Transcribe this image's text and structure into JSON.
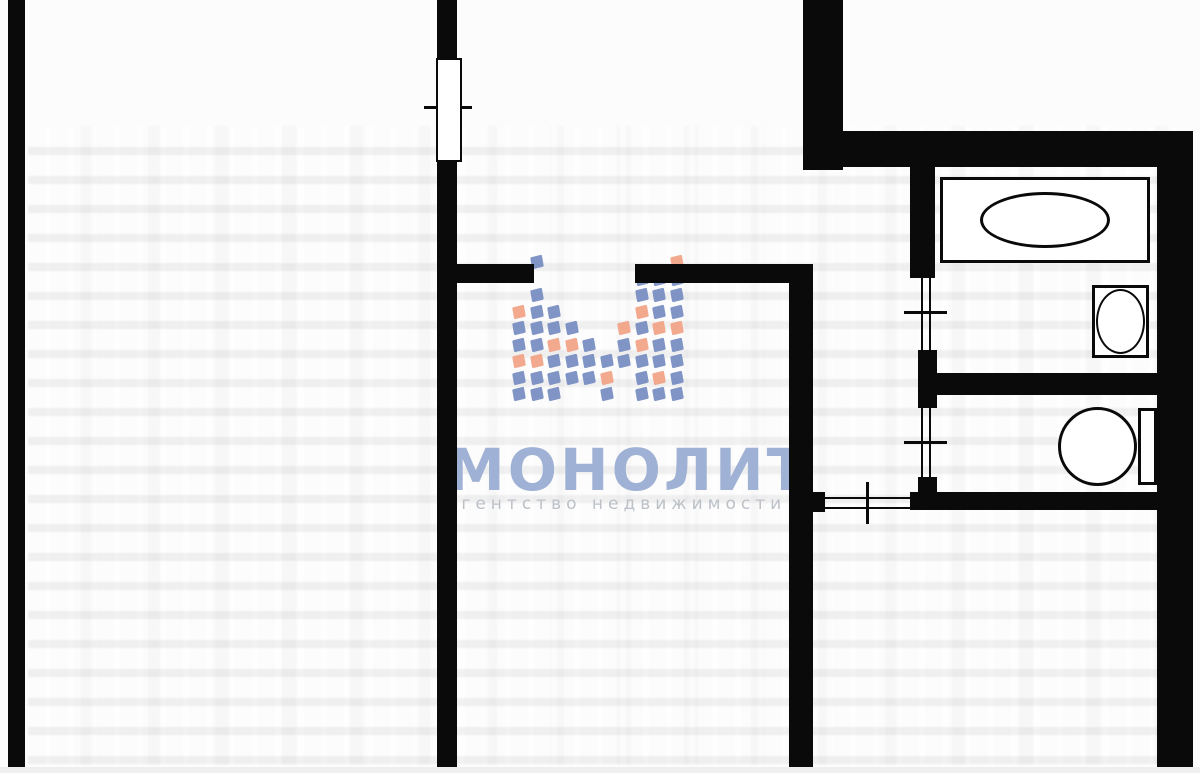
{
  "watermark": {
    "brand": "МОНОЛИТ",
    "tagline": "агентство недвижимости",
    "brand_color": "#9fb1d4",
    "tagline_color": "#bcc1c8",
    "m_blue": "#758cc0",
    "m_orange": "#f1a284",
    "m_grid": {
      "origin_x": 513,
      "origin_y": 256,
      "col_step": 17.5,
      "row_step": 16.5,
      "square": 12
    },
    "pattern": [
      [
        0,
        3,
        "o"
      ],
      [
        0,
        4,
        "b"
      ],
      [
        0,
        5,
        "b"
      ],
      [
        0,
        6,
        "o"
      ],
      [
        0,
        7,
        "b"
      ],
      [
        0,
        8,
        "b"
      ],
      [
        1,
        0,
        "b"
      ],
      [
        1,
        2,
        "b"
      ],
      [
        1,
        3,
        "b"
      ],
      [
        1,
        4,
        "b"
      ],
      [
        1,
        5,
        "b"
      ],
      [
        1,
        6,
        "o"
      ],
      [
        1,
        7,
        "b"
      ],
      [
        1,
        8,
        "b"
      ],
      [
        2,
        3,
        "b"
      ],
      [
        2,
        4,
        "b"
      ],
      [
        2,
        5,
        "o"
      ],
      [
        2,
        6,
        "b"
      ],
      [
        2,
        7,
        "b"
      ],
      [
        2,
        8,
        "b"
      ],
      [
        3,
        4,
        "b"
      ],
      [
        3,
        5,
        "o"
      ],
      [
        3,
        6,
        "b"
      ],
      [
        3,
        7,
        "b"
      ],
      [
        4,
        5,
        "b"
      ],
      [
        4,
        6,
        "b"
      ],
      [
        4,
        7,
        "b"
      ],
      [
        5,
        6,
        "b"
      ],
      [
        5,
        7,
        "o"
      ],
      [
        5,
        8,
        "b"
      ],
      [
        6,
        4,
        "o"
      ],
      [
        6,
        5,
        "b"
      ],
      [
        6,
        6,
        "b"
      ],
      [
        7,
        1,
        "b"
      ],
      [
        7,
        2,
        "b"
      ],
      [
        7,
        3,
        "o"
      ],
      [
        7,
        4,
        "b"
      ],
      [
        7,
        5,
        "o"
      ],
      [
        7,
        6,
        "b"
      ],
      [
        7,
        7,
        "b"
      ],
      [
        7,
        8,
        "b"
      ],
      [
        8,
        1,
        "b"
      ],
      [
        8,
        2,
        "b"
      ],
      [
        8,
        3,
        "b"
      ],
      [
        8,
        4,
        "o"
      ],
      [
        8,
        5,
        "b"
      ],
      [
        8,
        6,
        "b"
      ],
      [
        8,
        7,
        "o"
      ],
      [
        8,
        8,
        "b"
      ],
      [
        9,
        0,
        "o"
      ],
      [
        9,
        1,
        "b"
      ],
      [
        9,
        2,
        "b"
      ],
      [
        9,
        3,
        "b"
      ],
      [
        9,
        4,
        "o"
      ],
      [
        9,
        5,
        "b"
      ],
      [
        9,
        6,
        "b"
      ],
      [
        9,
        7,
        "b"
      ],
      [
        9,
        8,
        "b"
      ]
    ]
  },
  "plan": {
    "wall_color": "#0a0a0a",
    "paper_color": "#fcfcfc",
    "rects": [
      {
        "name": "outer-wall-left",
        "kind": "wall",
        "x": 8,
        "y": 0,
        "w": 17,
        "h": 768
      },
      {
        "name": "window-partition-upper",
        "kind": "wall",
        "x": 437,
        "y": 0,
        "w": 20,
        "h": 62
      },
      {
        "name": "window-partition-main",
        "kind": "wall",
        "x": 437,
        "y": 159,
        "w": 20,
        "h": 609
      },
      {
        "name": "room-divider-wall-left-seg",
        "kind": "wall",
        "x": 455,
        "y": 264,
        "w": 79,
        "h": 19
      },
      {
        "name": "room-divider-wall-right-seg",
        "kind": "wall",
        "x": 635,
        "y": 264,
        "w": 178,
        "h": 19
      },
      {
        "name": "corridor-wall-vertical",
        "kind": "wall",
        "x": 789,
        "y": 264,
        "w": 24,
        "h": 504
      },
      {
        "name": "hall-door-stub",
        "kind": "wall",
        "x": 813,
        "y": 492,
        "w": 12,
        "h": 20
      },
      {
        "name": "entrance-wall-vertical-thick",
        "kind": "wall",
        "x": 803,
        "y": 0,
        "w": 40,
        "h": 170
      },
      {
        "name": "entrance-wall-horizontal-thick",
        "kind": "wall",
        "x": 843,
        "y": 131,
        "w": 350,
        "h": 36
      },
      {
        "name": "outer-wall-right",
        "kind": "wall",
        "x": 1157,
        "y": 131,
        "w": 36,
        "h": 637
      },
      {
        "name": "bathroom-wall-upper",
        "kind": "wall",
        "x": 910,
        "y": 167,
        "w": 25,
        "h": 111
      },
      {
        "name": "bathroom-wall-mid",
        "kind": "wall",
        "x": 918,
        "y": 350,
        "w": 19,
        "h": 58
      },
      {
        "name": "bathroom-toilet-divider-wall",
        "kind": "wall",
        "x": 918,
        "y": 373,
        "w": 242,
        "h": 22
      },
      {
        "name": "bathroom-wall-lower",
        "kind": "wall",
        "x": 918,
        "y": 477,
        "w": 19,
        "h": 20
      },
      {
        "name": "toilet-bottom-wall",
        "kind": "wall",
        "x": 910,
        "y": 492,
        "w": 283,
        "h": 18
      },
      {
        "name": "bathroom-door-jamb-left",
        "kind": "line",
        "x": 921,
        "y": 278,
        "w": 2,
        "h": 72
      },
      {
        "name": "bathroom-door-jamb-right",
        "kind": "line",
        "x": 929,
        "y": 278,
        "w": 2,
        "h": 72
      },
      {
        "name": "toilet-door-jamb-left",
        "kind": "line",
        "x": 921,
        "y": 408,
        "w": 2,
        "h": 69
      },
      {
        "name": "toilet-door-jamb-right",
        "kind": "line",
        "x": 929,
        "y": 408,
        "w": 2,
        "h": 69
      },
      {
        "name": "hall-door-line-top",
        "kind": "line",
        "x": 825,
        "y": 497,
        "w": 87,
        "h": 2
      },
      {
        "name": "hall-door-line-bottom",
        "kind": "line",
        "x": 825,
        "y": 507,
        "w": 87,
        "h": 2
      },
      {
        "name": "window-tick",
        "kind": "line",
        "x": 424,
        "y": 106,
        "w": 48,
        "h": 3
      },
      {
        "name": "bathroom-door-tick",
        "kind": "line",
        "x": 904,
        "y": 311,
        "w": 43,
        "h": 3
      },
      {
        "name": "toilet-door-tick",
        "kind": "line",
        "x": 904,
        "y": 441,
        "w": 43,
        "h": 3
      },
      {
        "name": "hall-door-tick",
        "kind": "line",
        "x": 866,
        "y": 482,
        "w": 3,
        "h": 42
      },
      {
        "name": "window-frame",
        "kind": "window",
        "x": 436,
        "y": 58,
        "w": 26,
        "h": 104,
        "bw": 2
      },
      {
        "name": "bathtub",
        "kind": "fixture",
        "x": 940,
        "y": 177,
        "w": 210,
        "h": 86,
        "bw": 3
      },
      {
        "name": "bathtub-basin",
        "kind": "fixture-ellipse",
        "x": 980,
        "y": 192,
        "w": 130,
        "h": 56,
        "bw": 3
      },
      {
        "name": "sink",
        "kind": "fixture",
        "x": 1092,
        "y": 285,
        "w": 57,
        "h": 73,
        "bw": 3
      },
      {
        "name": "sink-basin",
        "kind": "fixture-ellipse",
        "x": 1096,
        "y": 289,
        "w": 49,
        "h": 65,
        "bw": 2
      },
      {
        "name": "toilet-bowl",
        "kind": "fixture-ellipse",
        "x": 1058,
        "y": 407,
        "w": 79,
        "h": 79,
        "bw": 3
      },
      {
        "name": "toilet-tank",
        "kind": "fixture",
        "x": 1138,
        "y": 408,
        "w": 19,
        "h": 77,
        "bw": 3
      }
    ]
  }
}
